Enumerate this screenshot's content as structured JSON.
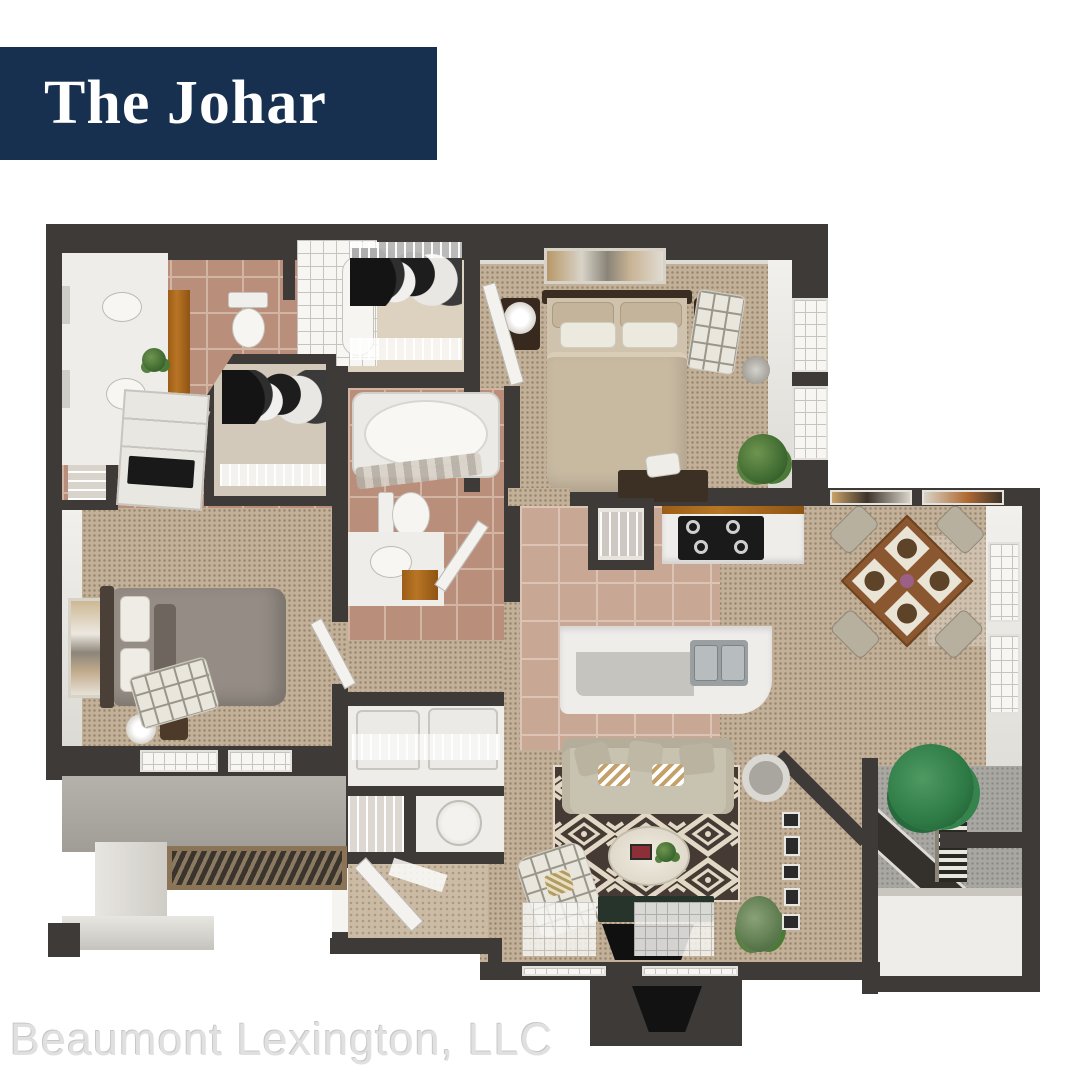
{
  "banner": {
    "title": "The Johar"
  },
  "watermark": {
    "text": "Beaumont Lexington, LLC"
  },
  "floor_plan": {
    "type": "3d-top-down-apartment-floor-plan",
    "rooms_depicted": [
      "master bathroom",
      "shower",
      "walk-in closet",
      "master bedroom",
      "linen closet",
      "second walk-in closet",
      "second bathroom",
      "second bedroom",
      "hallway",
      "laundry closet",
      "storage closets",
      "entry",
      "kitchen",
      "pantry",
      "dining area",
      "living room",
      "patio with storage",
      "entry porch"
    ],
    "colors": {
      "navy": "#17304f",
      "white": "#ffffff",
      "watermark": "#e0e0e0",
      "wall": "#3d3a37",
      "wallface": "#f2f0ec",
      "carpet": "#c3b098",
      "carpet2": "#cbbaa4",
      "bathtile": "#b98f7b",
      "bathgrout": "#d2b4a3",
      "kittile": "#c8a794",
      "kitgrout": "#dcc4b4",
      "white_floor": "#efedea",
      "wood": "#b87524",
      "tablewood": "#8a5730",
      "rug_dark": "#453a34",
      "rug_cream": "#e2d8c5",
      "sofa": "#c8c3b1",
      "bed_tan": "#c8b9a1",
      "bed_gray": "#958d85",
      "concrete": "#a9a7a1",
      "plant": "#3f6b31",
      "window": "#f7f6f3",
      "door": "#f4f2ee",
      "black": "#141414"
    }
  }
}
